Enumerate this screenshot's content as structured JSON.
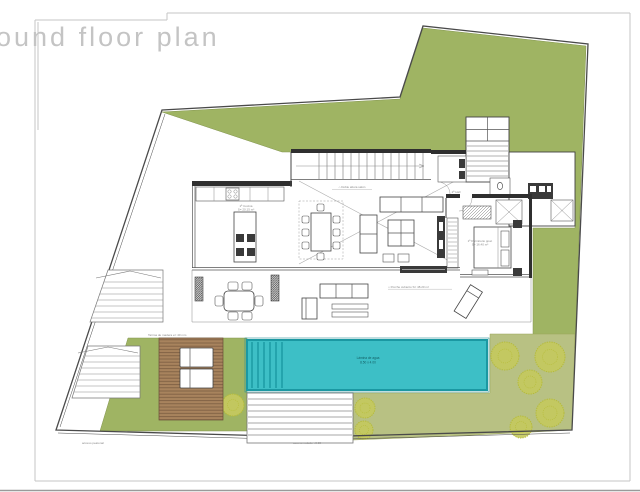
{
  "title": "ound floor plan",
  "colors": {
    "lawn": "#9fb463",
    "lawn-light": "#b8c183",
    "pool": "#3dbfc6",
    "pool-dark": "#1b98a2",
    "deck": "#a8835d",
    "deck-line": "#7a5c41",
    "tree": "#c5c95f",
    "tree-stroke": "#b5bb35",
    "wall": "#2f2f2f",
    "title": "#c4c4c4"
  },
  "labels": {
    "kitchen_name": "1ª Cocina",
    "kitchen_area": "S= 20.15 m²",
    "void_note": "⌂ Doble altura salón",
    "porch_note": "⌂ Porche cubierto  S= 48.20 m²",
    "bedroom_name": "1ª Dormitorio ppal.",
    "bedroom_area": "S= 16.40 m²",
    "hall_name": "2ª Hall",
    "pool_name": "Lámina de agua",
    "pool_dim": "8.50 x 4.00",
    "deck_note": "Tarima de madera e= 40 mm",
    "access_ped": "acceso peatonal",
    "access_road": "acceso rodado +0.00"
  }
}
